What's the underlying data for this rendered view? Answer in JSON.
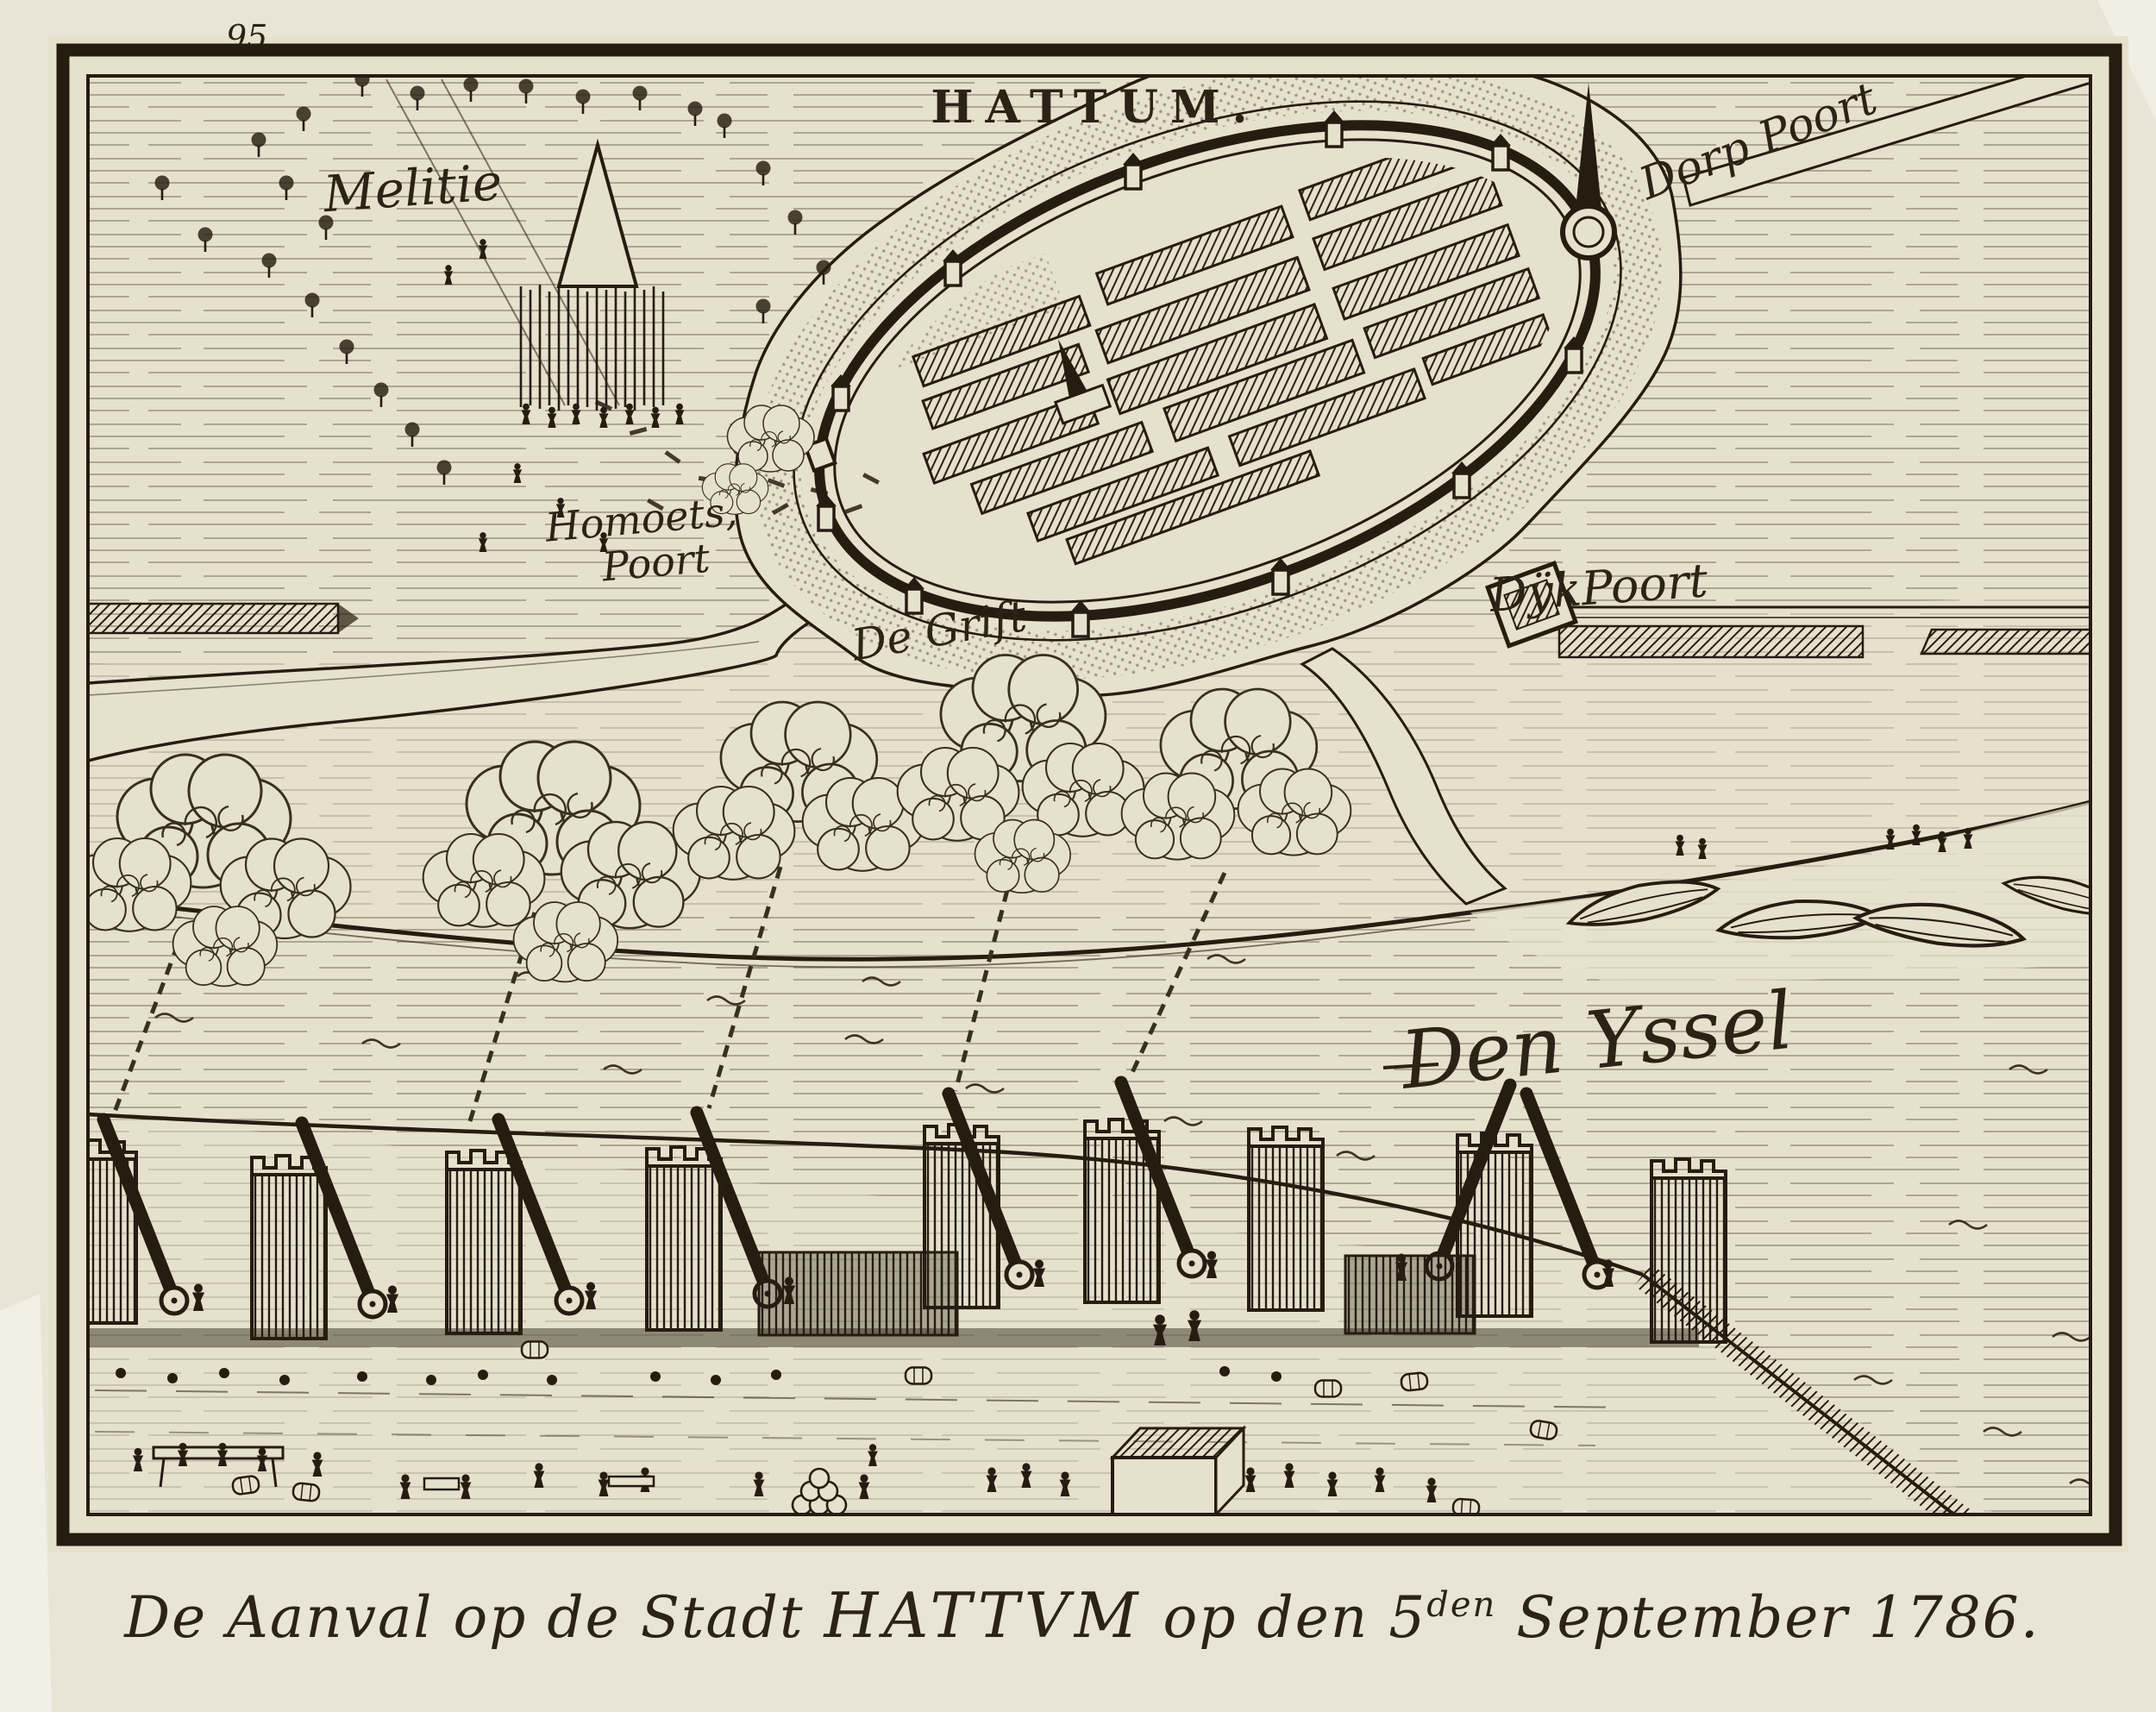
{
  "print": {
    "page_number": "95.",
    "title": "HATTUM.",
    "labels": {
      "melitie": "Melitie",
      "homoets_line1": "Homoets,",
      "homoets_line2": "Poort",
      "dorp_poort": "Dorp Poort",
      "dijk_poort": "DÿkPoort",
      "de_grift": "De Grift",
      "den_yssel": "Den Yssel"
    },
    "caption": {
      "prefix": "De Aanval op de Stadt ",
      "city": "HATTVM",
      "middle": " op den 5",
      "superscript": "den",
      "suffix": " September 1786."
    },
    "colors": {
      "paper": "#e6e1cd",
      "margin": "#e9e5d6",
      "ink": "#241d10",
      "etch_line": "#4c4534"
    }
  }
}
